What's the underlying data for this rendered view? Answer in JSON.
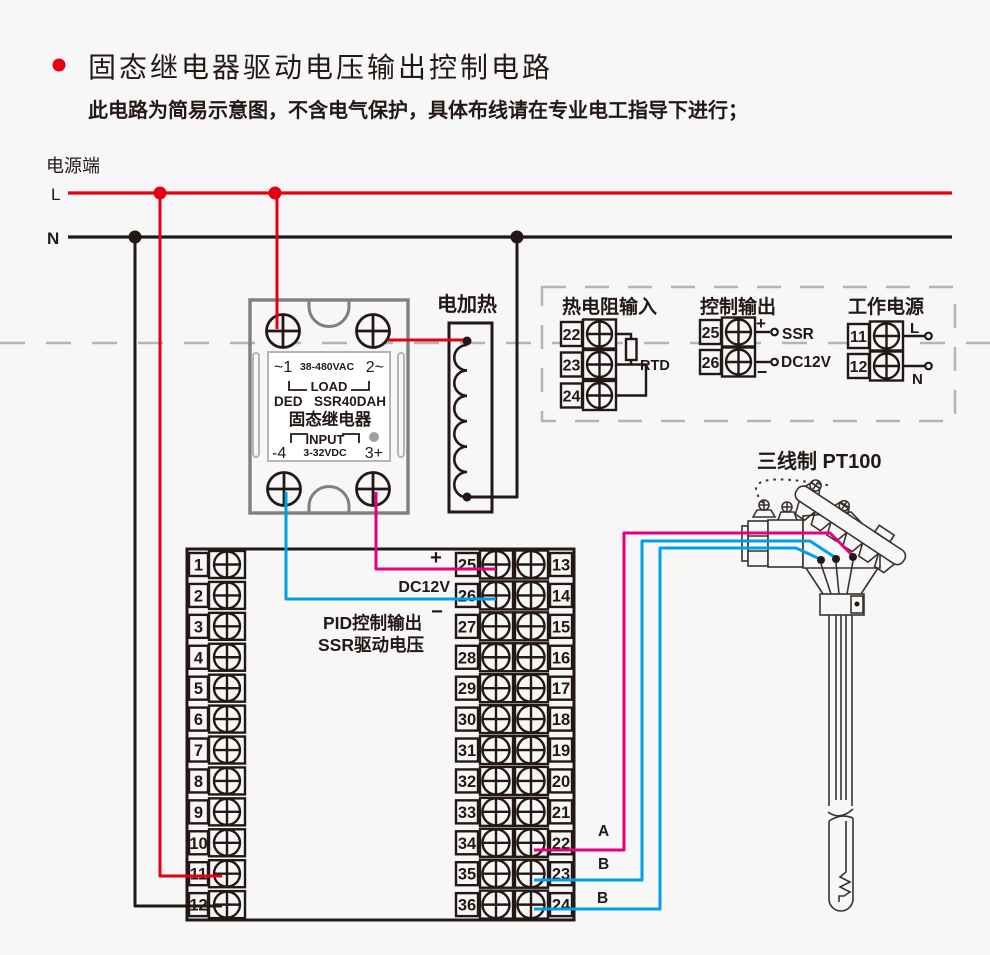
{
  "title": {
    "text": "固态继电器驱动电压输出控制电路",
    "subtitle": "此电路为简易示意图，不含电气保护，具体布线请在专业电工指导下进行；"
  },
  "power": {
    "label": "电源端",
    "l": "L",
    "n": "N"
  },
  "ssr": {
    "top_left": "~1",
    "voltage": "38-480VAC",
    "top_right": "2~",
    "load": "LOAD",
    "brand": "DED",
    "model": "SSR40DAH",
    "name": "固态继电器",
    "input": "INPUT",
    "in_left": "-4",
    "in_volt": "3-32VDC",
    "in_right": "3+"
  },
  "heater": {
    "label": "电加热"
  },
  "io_groups": {
    "rtd": {
      "title": "热电阻输入",
      "terminals": [
        "22",
        "23",
        "24"
      ],
      "label": "RTD"
    },
    "ctrl": {
      "title": "控制输出",
      "terminals": [
        "25",
        "26"
      ],
      "plus": "+",
      "minus": "−",
      "ssr": "SSR",
      "dc12v": "DC12V"
    },
    "power": {
      "title": "工作电源",
      "terminals": [
        "11",
        "12"
      ],
      "l": "L",
      "n": "N"
    }
  },
  "sensor": {
    "label": "三线制 PT100"
  },
  "block": {
    "left": [
      "1",
      "2",
      "3",
      "4",
      "5",
      "6",
      "7",
      "8",
      "9",
      "10",
      "11",
      "12"
    ],
    "mid": [
      "25",
      "26",
      "27",
      "28",
      "29",
      "30",
      "31",
      "32",
      "33",
      "34",
      "35",
      "36"
    ],
    "right": [
      "13",
      "14",
      "15",
      "16",
      "17",
      "18",
      "19",
      "20",
      "21",
      "22",
      "23",
      "24"
    ],
    "plus": "+",
    "dc12v": "DC12V",
    "minus": "−",
    "pid_line1": "PID控制输出",
    "pid_line2": "SSR驱动电压",
    "wire_a": "A",
    "wire_b1": "B",
    "wire_b2": "B"
  },
  "colors": {
    "red": "#e60012",
    "magenta": "#e6007e",
    "cyan": "#00a0e9",
    "line": "#231815",
    "ssr_gray": "#7f7f7f",
    "soft_gray": "#b5b5b5",
    "dash_gray": "#b4b4b5",
    "led_gray": "#9fa0a0",
    "bg": "#f7f7f7"
  }
}
